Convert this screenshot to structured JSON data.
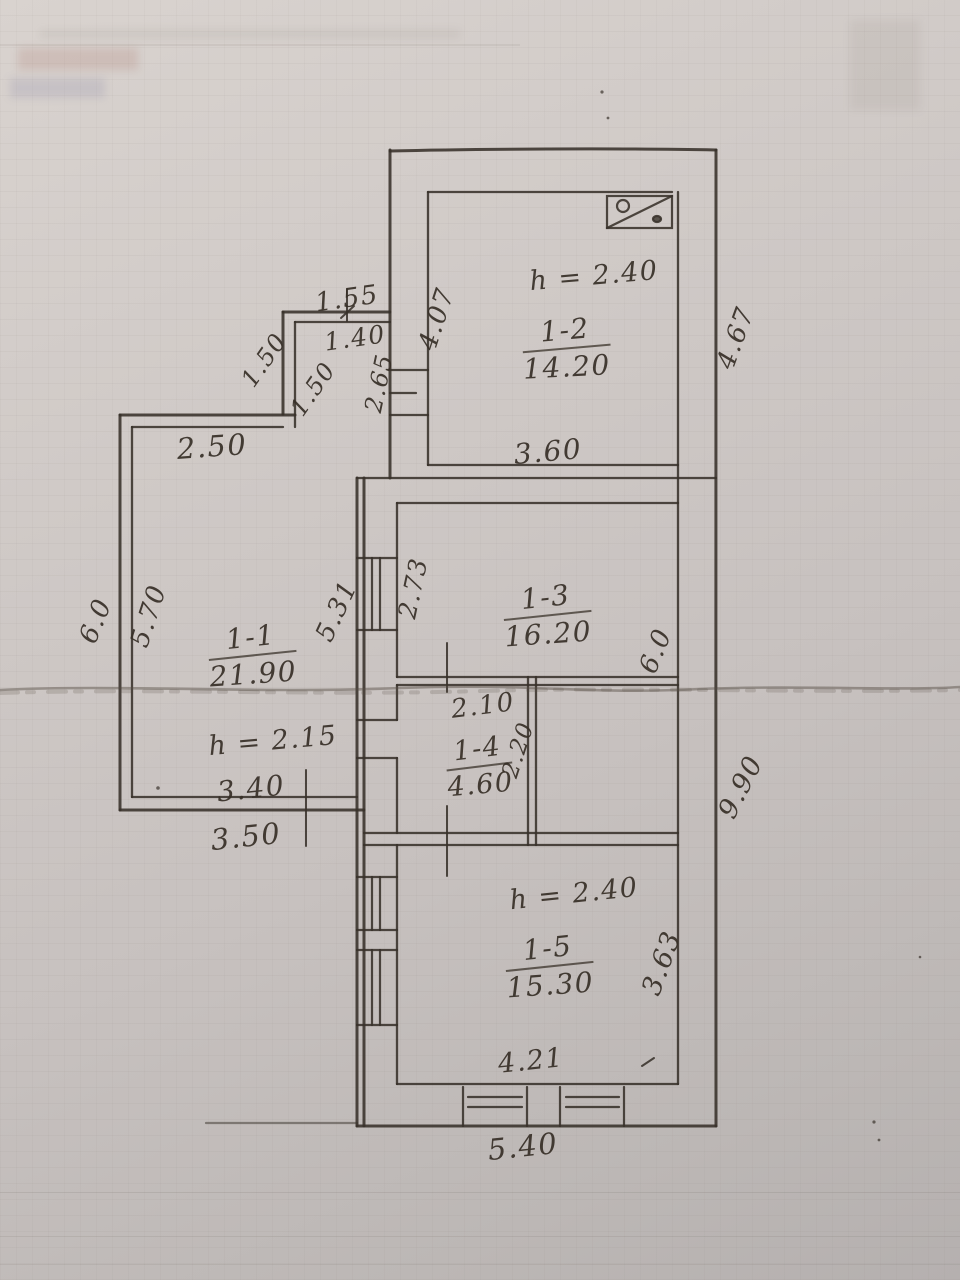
{
  "document": {
    "kind": "scanned hand-drawn floor plan",
    "paper_color": "#cfc9c6",
    "ink_color": "#372f27"
  },
  "plan": {
    "height_label_prefix": "h =",
    "rooms": [
      {
        "number": "1-1",
        "area": "21.90",
        "ceiling_height": "2.15"
      },
      {
        "number": "1-2",
        "area": "14.20",
        "ceiling_height": "2.40"
      },
      {
        "number": "1-3",
        "area": "16.20"
      },
      {
        "number": "1-4",
        "area": "4.60"
      },
      {
        "number": "1-5",
        "area": "15.30",
        "ceiling_height": "2.40"
      }
    ],
    "labels": [
      {
        "kind": "room",
        "room": 1,
        "x": 566,
        "y": 349,
        "rot": -3,
        "size": 28
      },
      {
        "kind": "height",
        "room": 1,
        "x": 594,
        "y": 276,
        "rot": -5,
        "size": 27
      },
      {
        "kind": "room",
        "room": 0,
        "x": 252,
        "y": 656,
        "rot": -4,
        "size": 28
      },
      {
        "kind": "height",
        "room": 0,
        "x": 273,
        "y": 741,
        "rot": -5,
        "size": 27
      },
      {
        "kind": "room",
        "room": 2,
        "x": 547,
        "y": 616,
        "rot": -4,
        "size": 28
      },
      {
        "kind": "room",
        "room": 3,
        "x": 479,
        "y": 767,
        "rot": -5,
        "size": 27
      },
      {
        "kind": "room",
        "room": 4,
        "x": 549,
        "y": 967,
        "rot": -4,
        "size": 28
      },
      {
        "kind": "height",
        "room": 4,
        "x": 574,
        "y": 894,
        "rot": -6,
        "size": 27
      },
      {
        "kind": "dim",
        "text": "1.55",
        "x": 347,
        "y": 299,
        "rot": -8,
        "size": 26
      },
      {
        "kind": "dim",
        "text": "1.40",
        "x": 355,
        "y": 338,
        "rot": -8,
        "size": 25
      },
      {
        "kind": "dim",
        "text": "1.50",
        "x": 264,
        "y": 360,
        "rot": -55,
        "size": 24
      },
      {
        "kind": "dim",
        "text": "1.50",
        "x": 313,
        "y": 389,
        "rot": -55,
        "size": 24
      },
      {
        "kind": "dim",
        "text": "2.65",
        "x": 379,
        "y": 383,
        "rot": -78,
        "size": 24
      },
      {
        "kind": "dim",
        "text": "2.50",
        "x": 212,
        "y": 447,
        "rot": -4,
        "size": 29
      },
      {
        "kind": "dim",
        "text": "4.07",
        "x": 437,
        "y": 319,
        "rot": -72,
        "size": 26
      },
      {
        "kind": "dim",
        "text": "3.60",
        "x": 548,
        "y": 452,
        "rot": -5,
        "size": 28
      },
      {
        "kind": "dim",
        "text": "4.67",
        "x": 736,
        "y": 338,
        "rot": -70,
        "size": 26
      },
      {
        "kind": "dim",
        "text": "6.0",
        "x": 96,
        "y": 621,
        "rot": -68,
        "size": 26
      },
      {
        "kind": "dim",
        "text": "5.70",
        "x": 149,
        "y": 616,
        "rot": -72,
        "size": 26
      },
      {
        "kind": "dim",
        "text": "5.31",
        "x": 337,
        "y": 611,
        "rot": -65,
        "size": 26
      },
      {
        "kind": "dim",
        "text": "2.73",
        "x": 413,
        "y": 588,
        "rot": -78,
        "size": 25
      },
      {
        "kind": "dim",
        "text": "6.0",
        "x": 656,
        "y": 651,
        "rot": -68,
        "size": 26
      },
      {
        "kind": "dim",
        "text": "2.10",
        "x": 483,
        "y": 706,
        "rot": -7,
        "size": 26
      },
      {
        "kind": "dim",
        "text": "2.20",
        "x": 519,
        "y": 750,
        "rot": -72,
        "size": 23
      },
      {
        "kind": "dim",
        "text": "3.40",
        "x": 251,
        "y": 789,
        "rot": -6,
        "size": 28
      },
      {
        "kind": "dim",
        "text": "3.50",
        "x": 246,
        "y": 837,
        "rot": -6,
        "size": 29
      },
      {
        "kind": "dim",
        "text": "9.90",
        "x": 741,
        "y": 787,
        "rot": -63,
        "size": 27
      },
      {
        "kind": "dim",
        "text": "3.63",
        "x": 662,
        "y": 963,
        "rot": -70,
        "size": 27
      },
      {
        "kind": "dim",
        "text": "4.21",
        "x": 531,
        "y": 1061,
        "rot": -6,
        "size": 27
      },
      {
        "kind": "dim",
        "text": "5.40",
        "x": 523,
        "y": 1147,
        "rot": -6,
        "size": 29
      }
    ]
  }
}
